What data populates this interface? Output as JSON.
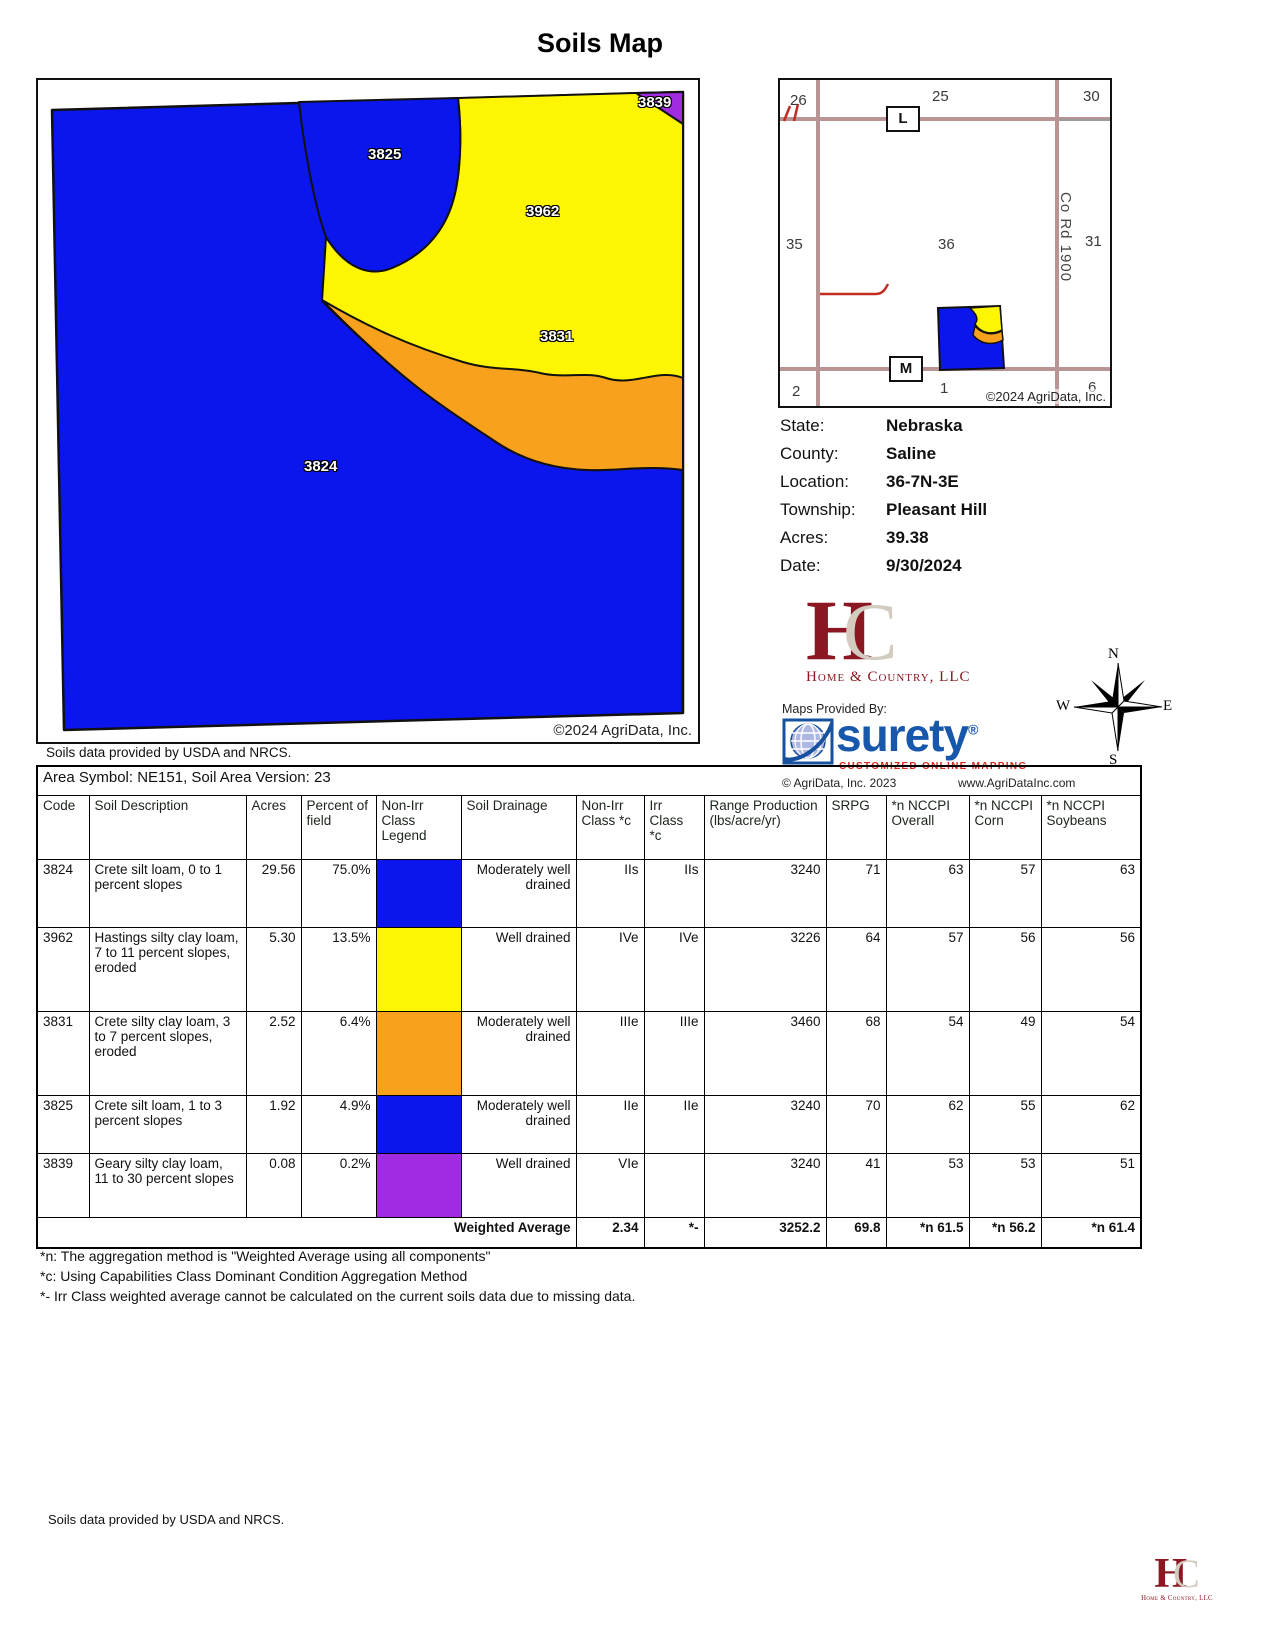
{
  "title": "Soils Map",
  "notes": {
    "usda": "Soils data provided by USDA and NRCS.",
    "agridata_2024": "©2024 AgriData, Inc."
  },
  "main_map": {
    "regions": [
      {
        "code": "3824",
        "color": "#0b16ec"
      },
      {
        "code": "3825",
        "color": "#0b16ec"
      },
      {
        "code": "3962",
        "color": "#fdf501"
      },
      {
        "code": "3831",
        "color": "#f7a11c"
      },
      {
        "code": "3839",
        "color": "#a02be0"
      }
    ]
  },
  "location_map": {
    "sections": [
      "26",
      "25",
      "30",
      "35",
      "36",
      "31",
      "2",
      "1",
      "6"
    ],
    "road_label_l": "L",
    "road_label_m": "M",
    "road_name": "Co Rd 1900"
  },
  "info": {
    "rows": [
      {
        "label": "State:",
        "value": "Nebraska"
      },
      {
        "label": "County:",
        "value": "Saline"
      },
      {
        "label": "Location:",
        "value": "36-7N-3E"
      },
      {
        "label": "Township:",
        "value": "Pleasant Hill"
      },
      {
        "label": "Acres:",
        "value": "39.38"
      },
      {
        "label": "Date:",
        "value": "9/30/2024"
      }
    ]
  },
  "hc_logo": {
    "h": "H",
    "c": "C",
    "name": "Home & Country, LLC"
  },
  "surety": {
    "provided_by": "Maps Provided By:",
    "name": "surety",
    "reg": "®",
    "tagline": "CUSTOMIZED ONLINE MAPPING",
    "copyright": "© AgriData, Inc. 2023",
    "website": "www.AgriDataInc.com"
  },
  "compass": {
    "n": "N",
    "e": "E",
    "s": "S",
    "w": "W"
  },
  "table": {
    "area_header": "Area Symbol: NE151, Soil Area Version: 23",
    "columns": [
      "Code",
      "Soil Description",
      "Acres",
      "Percent of field",
      "Non-Irr Class Legend",
      "Soil Drainage",
      "Non-Irr Class *c",
      "Irr Class *c",
      "Range Production (lbs/acre/yr)",
      "SRPG",
      "*n NCCPI Overall",
      "*n NCCPI Corn",
      "*n NCCPI Soybeans"
    ],
    "rows": [
      {
        "code": "3824",
        "desc": "Crete silt loam, 0 to 1 percent slopes",
        "acres": "29.56",
        "pct": "75.0%",
        "color": "#0b16ec",
        "drainage": "Moderately well drained",
        "nonirr": "IIs",
        "irr": "IIs",
        "range": "3240",
        "srpg": "71",
        "overall": "63",
        "corn": "57",
        "soy": "63"
      },
      {
        "code": "3962",
        "desc": "Hastings silty clay loam, 7 to 11 percent slopes, eroded",
        "acres": "5.30",
        "pct": "13.5%",
        "color": "#fdf501",
        "drainage": "Well drained",
        "nonirr": "IVe",
        "irr": "IVe",
        "range": "3226",
        "srpg": "64",
        "overall": "57",
        "corn": "56",
        "soy": "56"
      },
      {
        "code": "3831",
        "desc": "Crete silty clay loam, 3 to 7 percent slopes, eroded",
        "acres": "2.52",
        "pct": "6.4%",
        "color": "#f7a11c",
        "drainage": "Moderately well drained",
        "nonirr": "IIIe",
        "irr": "IIIe",
        "range": "3460",
        "srpg": "68",
        "overall": "54",
        "corn": "49",
        "soy": "54"
      },
      {
        "code": "3825",
        "desc": "Crete silt loam, 1 to 3 percent slopes",
        "acres": "1.92",
        "pct": "4.9%",
        "color": "#0b16ec",
        "drainage": "Moderately well drained",
        "nonirr": "IIe",
        "irr": "IIe",
        "range": "3240",
        "srpg": "70",
        "overall": "62",
        "corn": "55",
        "soy": "62"
      },
      {
        "code": "3839",
        "desc": "Geary silty clay loam, 11 to 30 percent slopes",
        "acres": "0.08",
        "pct": "0.2%",
        "color": "#a02be0",
        "drainage": "Well drained",
        "nonirr": "VIe",
        "irr": "",
        "range": "3240",
        "srpg": "41",
        "overall": "53",
        "corn": "53",
        "soy": "51"
      }
    ],
    "weighted": {
      "label": "Weighted Average",
      "nonirr": "2.34",
      "irr": "*-",
      "range": "3252.2",
      "srpg": "69.8",
      "overall": "*n 61.5",
      "corn": "*n 56.2",
      "soy": "*n 61.4"
    }
  },
  "footnotes": [
    "*n: The aggregation method is \"Weighted Average using all components\"",
    "*c: Using Capabilities Class Dominant Condition Aggregation Method",
    "*- Irr Class weighted average cannot be calculated on the current soils data due to missing data."
  ]
}
